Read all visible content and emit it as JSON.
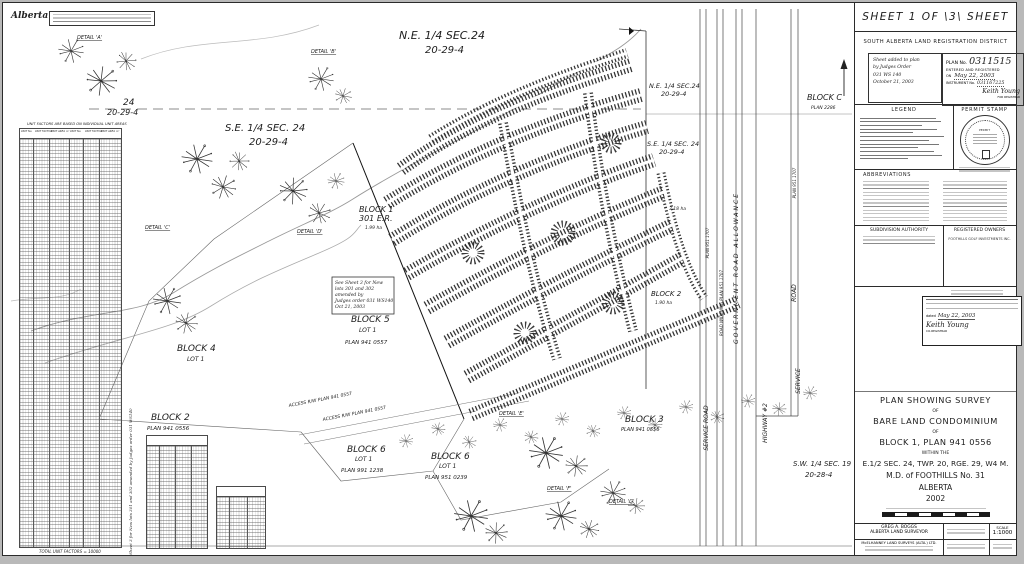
{
  "colors": {
    "ink": "#1c1c1c",
    "paper": "#ffffff",
    "faint": "#8b8b8b"
  },
  "logo": "Alberta",
  "header": {
    "sheet_title": "SHEET 1 OF \\3\\ SHEET"
  },
  "registration": {
    "district": "SOUTH ALBERTA LAND REGISTRATION DISTRICT",
    "added_note": [
      "Sheet added to plan",
      "by Judges Order",
      "031 WS 140",
      "October 21, 2003"
    ],
    "plan_no_label": "PLAN No.",
    "plan_no": "0311515",
    "entered": "ENTERED AND REGISTERED",
    "on_label": "ON",
    "date": "May 22, 2003",
    "instrument_label": "INSTRUMENT No.",
    "instrument_no": "031167225",
    "signer": "Keith Young",
    "signer_title": "FOR REGISTRAR"
  },
  "legend": {
    "title": "LEGEND"
  },
  "permit": {
    "title": "PERMIT STAMP",
    "word": "PERMIT"
  },
  "abbreviations": {
    "title": "ABBREVIATIONS"
  },
  "authority": {
    "title": "SUBDIVISION AUTHORITY"
  },
  "owners": {
    "title": "REGISTERED OWNERS",
    "name": "FOOTHILLS GOLF INVESTMENTS INC."
  },
  "cert": {
    "dated_label": "dated",
    "date": "May 22, 2003",
    "signer": "Keith Young",
    "signer_title": "CO-REGISTRAR"
  },
  "title_block": {
    "l1": "PLAN SHOWING SURVEY",
    "of1": "OF",
    "l2": "BARE LAND CONDOMINIUM",
    "of2": "OF",
    "l3": "BLOCK 1, PLAN 941 0556",
    "within": "WITHIN THE",
    "l4": "E.1/2 SEC. 24, TWP. 20, RGE. 29, W4 M.",
    "l5": "M.D. of FOOTHILLS No. 31",
    "l6": "ALBERTA",
    "l7": "2002"
  },
  "footer": {
    "surveyor1": "GREG A. BOGGS",
    "surveyor2": "ALBERTA LAND SURVEYOR",
    "firm": "McELHANNEY LAND SURVEYS (ALTA.) LTD.",
    "scale_label": "SCALE",
    "scale": "1:1000"
  },
  "unit_table": {
    "note": "UNIT FACTORS ARE BASED ON INDIVIDUAL UNIT AREAS",
    "headers": [
      "UNIT No.",
      "UNIT FACTOR",
      "UNIT AREA m²",
      "UNIT No.",
      "UNIT FACTOR",
      "UNIT AREA m²"
    ],
    "total": "TOTAL UNIT FACTORS = 10000"
  },
  "map": {
    "river": "SHEEP RIVER",
    "labels": [
      {
        "t": "N.E. 1/4 SEC.24"
      },
      {
        "t": "20-29-4"
      },
      {
        "t": "24"
      },
      {
        "t": "20-29-4"
      },
      {
        "t": "S.E. 1/4 SEC. 24"
      },
      {
        "t": "20-29-4"
      },
      {
        "t": "N.E. 1/4 SEC.24"
      },
      {
        "t": "20-29-4"
      },
      {
        "t": "S.E. 1/4 SEC. 24"
      },
      {
        "t": "20-29-4"
      },
      {
        "t": "BLOCK C"
      },
      {
        "t": "PLAN 2286"
      },
      {
        "t": "BLOCK 1"
      },
      {
        "t": "301 E.R."
      },
      {
        "t": "1.99 ha"
      },
      {
        "t": "3.18 ha"
      },
      {
        "t": "BLOCK 2"
      },
      {
        "t": "1.90 ha"
      },
      {
        "t": "See Sheet 3 for New"
      },
      {
        "t": "lots 301 and 302"
      },
      {
        "t": "amended by"
      },
      {
        "t": "Judges order 031 WS140"
      },
      {
        "t": "Oct 21, 2003"
      },
      {
        "t": "BLOCK 5"
      },
      {
        "t": "LOT 1"
      },
      {
        "t": "PLAN 941 0557"
      },
      {
        "t": "BLOCK 4"
      },
      {
        "t": "LOT 1"
      },
      {
        "t": "BLOCK 2"
      },
      {
        "t": "PLAN 941 0556"
      },
      {
        "t": "BLOCK 6"
      },
      {
        "t": "LOT 1"
      },
      {
        "t": "PLAN 991 1238"
      },
      {
        "t": "BLOCK 6"
      },
      {
        "t": "LOT 1"
      },
      {
        "t": "PLAN 951 0239"
      },
      {
        "t": "BLOCK 3"
      },
      {
        "t": "PLAN 941 0556"
      },
      {
        "t": "ACCESS R/W PLAN 941 0557"
      },
      {
        "t": "ACCESS R/W PLAN 941 0557"
      },
      {
        "t": "GOVERNMENT   ROAD   ALLOWANCE"
      },
      {
        "t": "ROAD WIDENING PLAN 951 1707"
      },
      {
        "t": "PLAN 951 1707"
      },
      {
        "t": "PLAN 951 1707"
      },
      {
        "t": "ROAD"
      },
      {
        "t": "SERVICE"
      },
      {
        "t": "SERVICE  ROAD"
      },
      {
        "t": "HIGHWAY  #2"
      },
      {
        "t": "S.W. 1/4 SEC. 19"
      },
      {
        "t": "20-28-4"
      },
      {
        "t": "DETAIL 'A'"
      },
      {
        "t": "DETAIL 'B'"
      },
      {
        "t": "DETAIL 'C'"
      },
      {
        "t": "DETAIL 'D'"
      },
      {
        "t": "DETAIL 'E'"
      },
      {
        "t": "DETAIL 'F'"
      },
      {
        "t": "DETAIL 'G'"
      },
      {
        "t": "See Sheet 3 for New lots 301 and 302 amended by Judges order 031 WS140"
      },
      {
        "t": "TOTAL UNIT FACTORS = 10000"
      },
      {
        "t": "UNIT FACTORS ARE BASED ON INDIVIDUAL UNIT AREAS"
      }
    ]
  }
}
